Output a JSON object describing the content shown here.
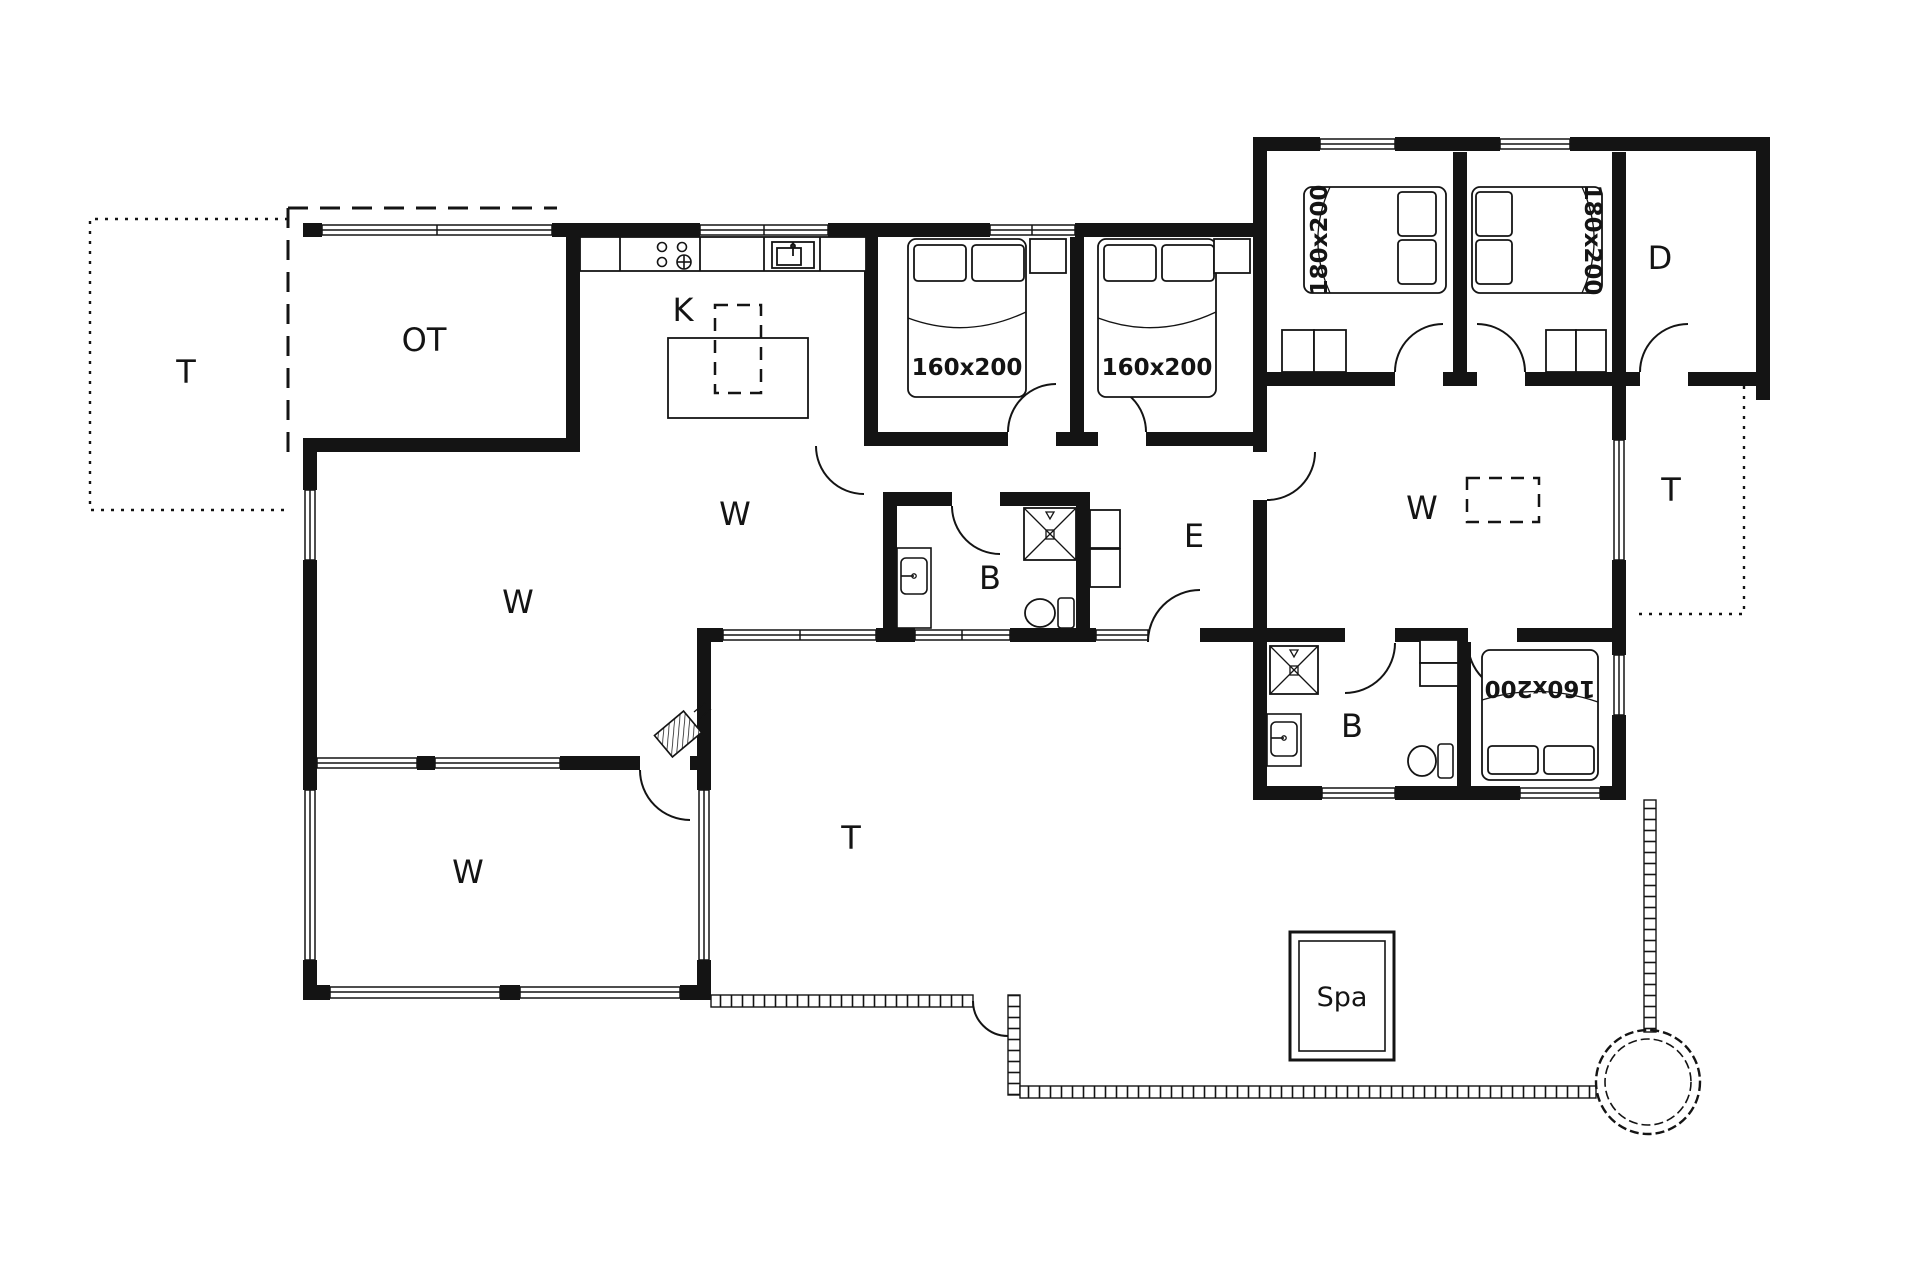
{
  "drawing": {
    "type": "architectural floor plan",
    "background_color": "#ffffff",
    "ink_color": "#141414"
  },
  "rooms": {
    "terrace_left": {
      "label": "T"
    },
    "covered_terrace": {
      "label": "OT"
    },
    "kitchen": {
      "label": "K"
    },
    "living_kitchen": {
      "label": "W"
    },
    "living_left": {
      "label": "W"
    },
    "conservatory": {
      "label": "W"
    },
    "bathroom_main": {
      "label": "B"
    },
    "entrance": {
      "label": "E"
    },
    "living_right": {
      "label": "W"
    },
    "room_d": {
      "label": "D"
    },
    "terrace_right": {
      "label": "T"
    },
    "bathroom_right": {
      "label": "B"
    },
    "terrace_bottom": {
      "label": "T"
    },
    "spa": {
      "label": "Spa"
    }
  },
  "beds": {
    "bedroom1": {
      "size": "160x200"
    },
    "bedroom2": {
      "size": "160x200"
    },
    "bedroom3": {
      "size": "180x200"
    },
    "bedroom4": {
      "size": "180x200"
    },
    "bedroom5": {
      "size": "160x200"
    }
  }
}
